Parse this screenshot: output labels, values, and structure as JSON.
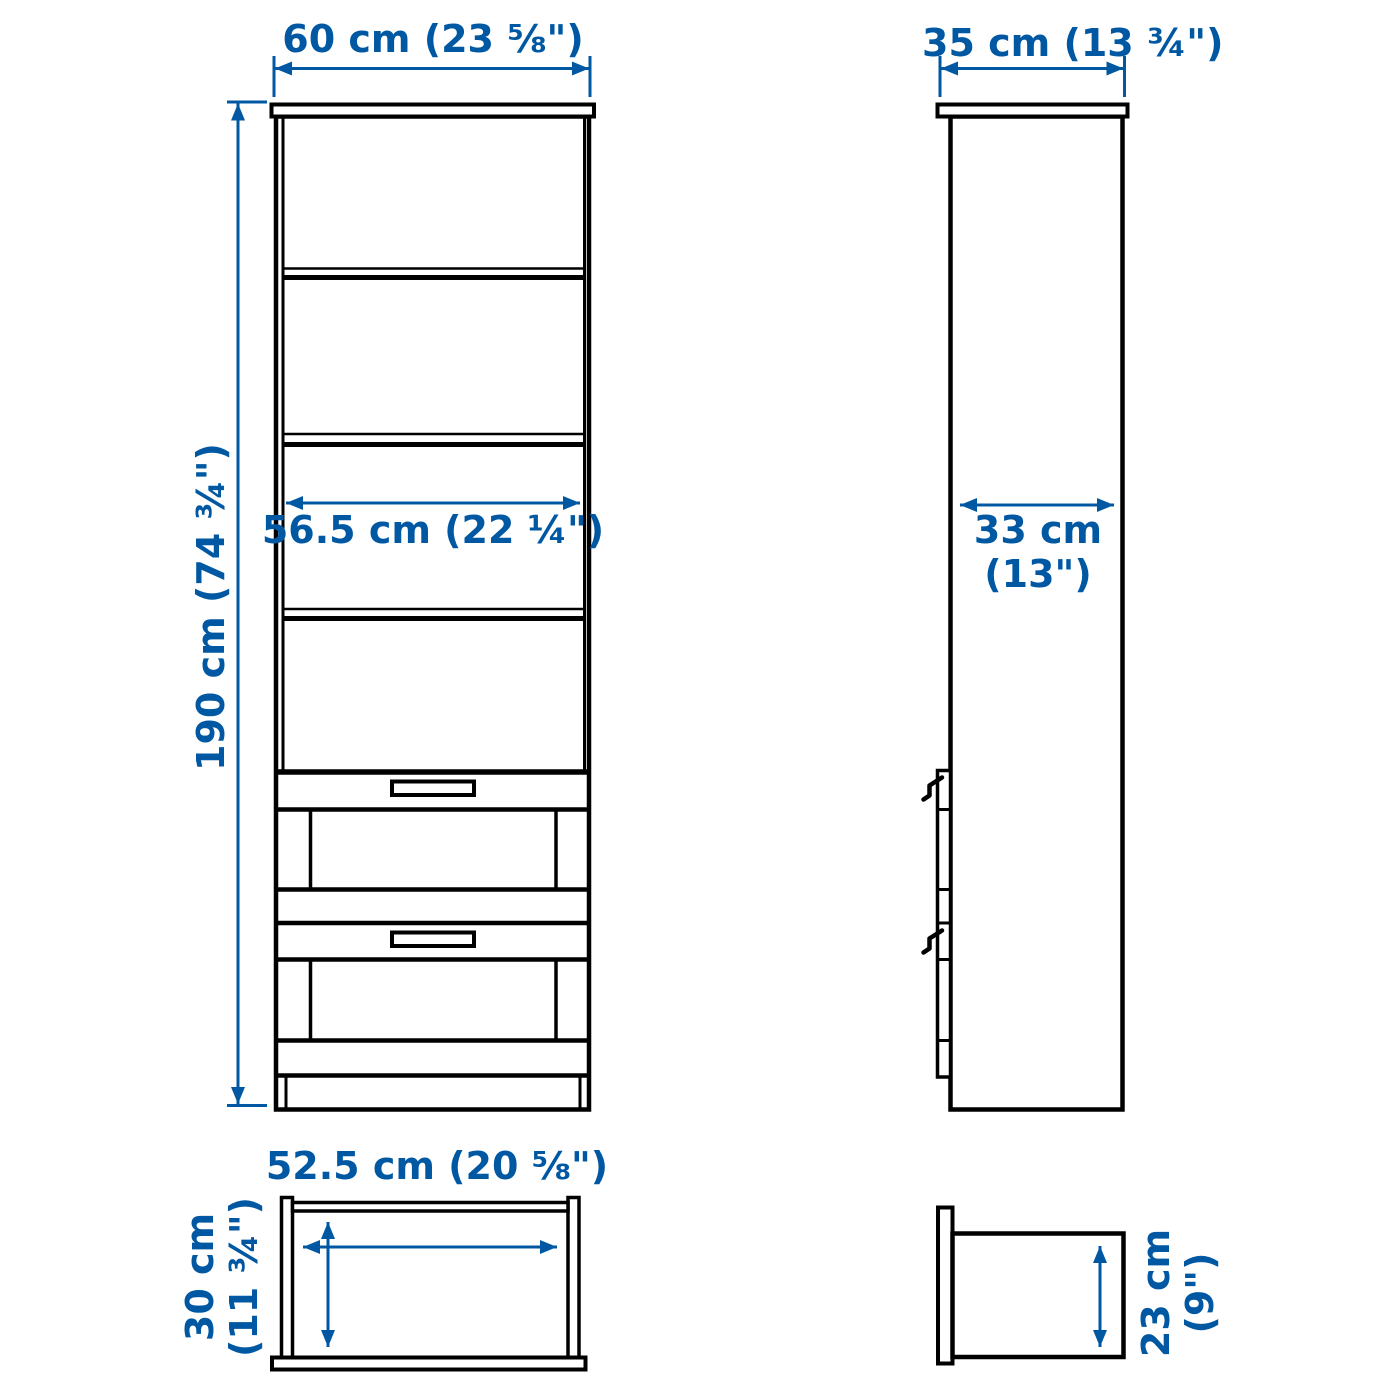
{
  "title": "bookcase dimension diagram",
  "colors": {
    "dimension_blue": "#0058a3",
    "outline_black": "#000000",
    "background": "#ffffff"
  },
  "labels": {
    "front_width": "60 cm (23 ⅝\")",
    "side_depth": "35 cm (13 ¾\")",
    "front_height": "190 cm (74 ¾\")",
    "front_inner_width": "56.5 cm (22 ¼\")",
    "side_inner_depth": [
      "33 cm",
      "(13\")"
    ],
    "drawer_front_width": "52.5 cm (20 ⅝\")",
    "drawer_front_height": [
      "30 cm",
      "(11 ¾\")"
    ],
    "drawer_side_depth": [
      "23 cm",
      "(9\")"
    ]
  }
}
